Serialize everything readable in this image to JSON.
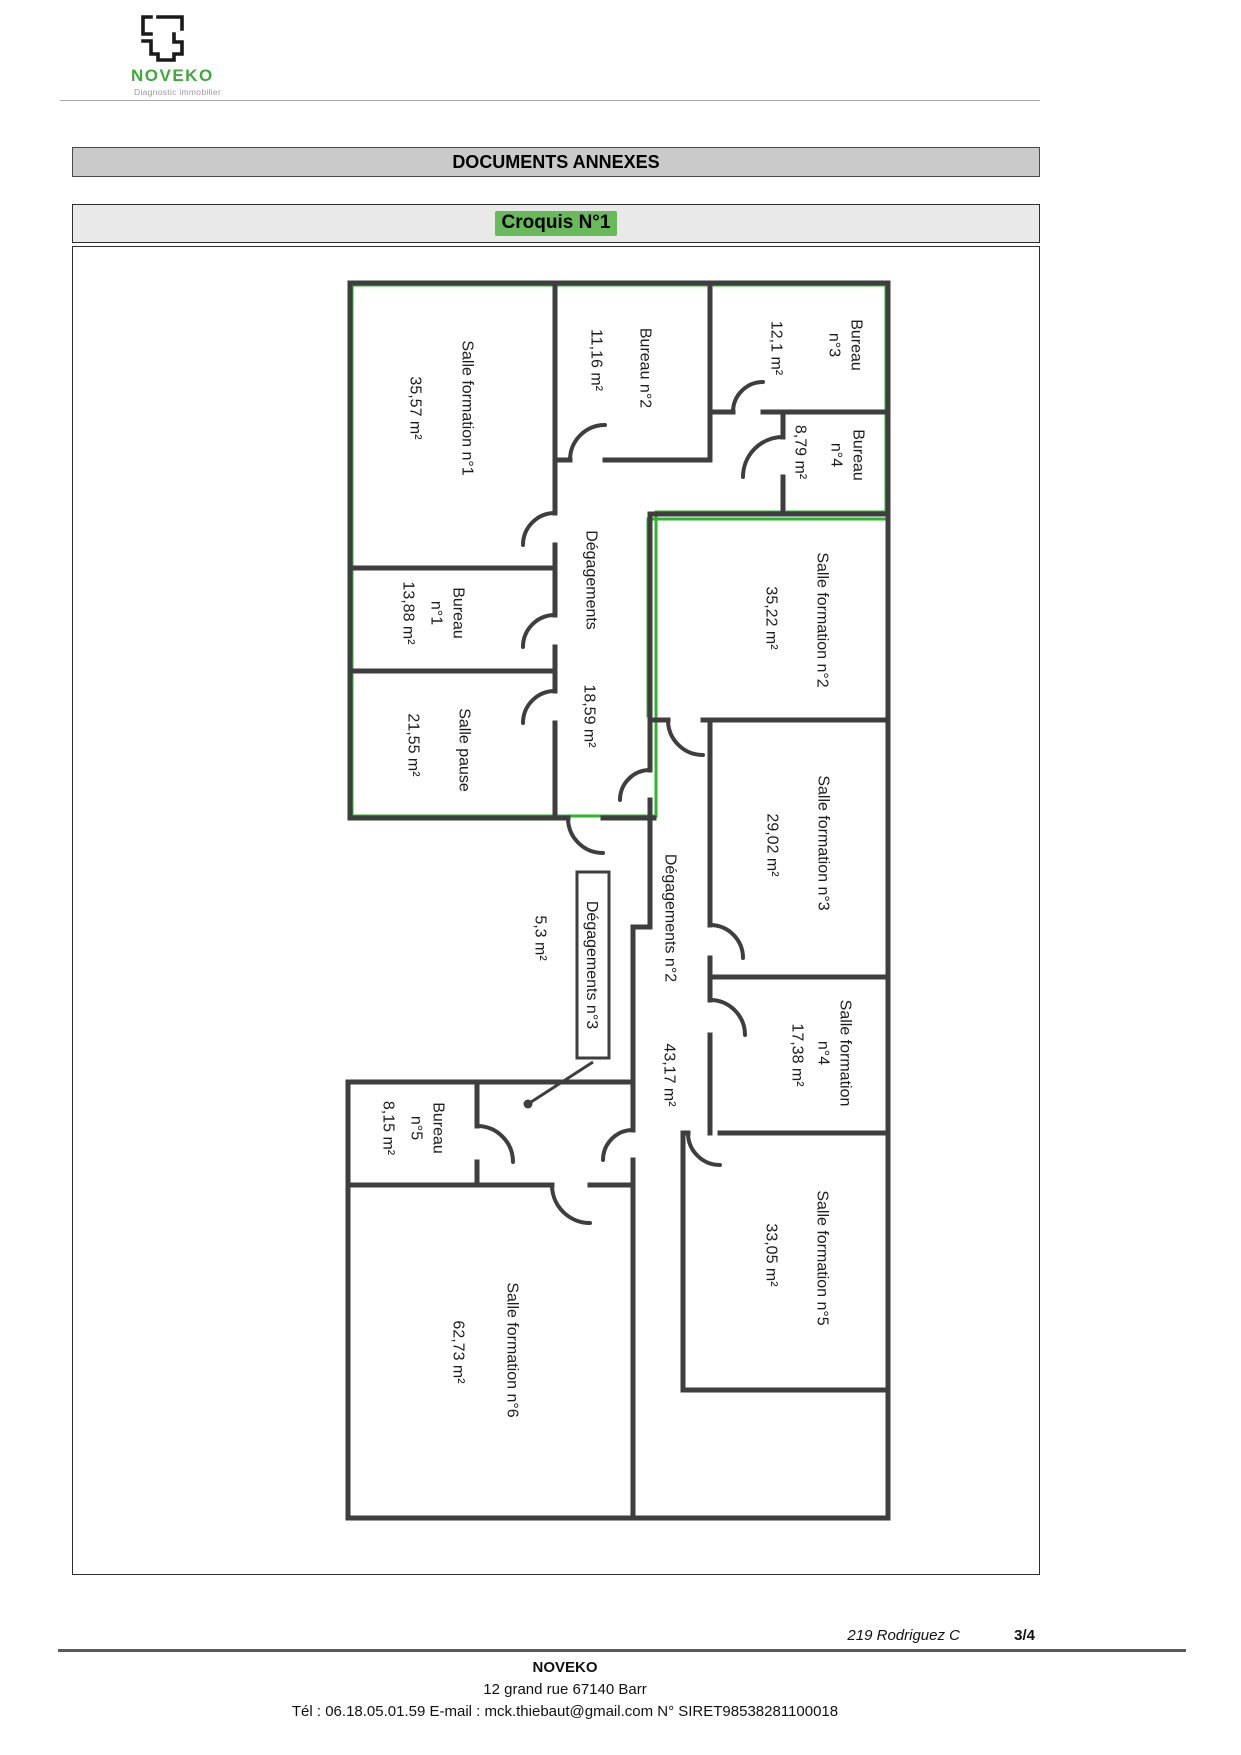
{
  "logo": {
    "brand": "NOVEKO",
    "tagline": "Diagnostic immobilier",
    "brand_color": "#3fa83f"
  },
  "header": {
    "title": "DOCUMENTS ANNEXES"
  },
  "croquis": {
    "title": "Croquis N°1",
    "highlight_color": "#68ba5a"
  },
  "floorplan": {
    "wall_color": "#3e3e3e",
    "lot_outline_color": "#2db52d",
    "rooms": [
      {
        "name": "Salle formation n°1",
        "area": "35,57 m²"
      },
      {
        "name": "Bureau n°2",
        "area": "11,16 m²"
      },
      {
        "name": "Bureau n°3",
        "line1": "Bureau",
        "line2": "n°3",
        "area": "12,1 m²"
      },
      {
        "name": "Bureau n°4",
        "line1": "Bureau",
        "line2": "n°4",
        "area": "8,79 m²"
      },
      {
        "name": "Bureau n°1",
        "line1": "Bureau",
        "line2": "n°1",
        "area": "13,88 m²"
      },
      {
        "name": "Salle pause",
        "area": "21,55 m²"
      },
      {
        "name": "Dégagements",
        "area": "18,59 m²"
      },
      {
        "name": "Salle formation n°2",
        "area": "35,22 m²"
      },
      {
        "name": "Salle formation n°3",
        "area": "29,02 m²"
      },
      {
        "name": "Dégagements n°2",
        "area": "43,17 m²"
      },
      {
        "name": "Dégagements n°3",
        "area": "5,3 m²"
      },
      {
        "name": "Salle formation n°4",
        "line1": "Salle formation",
        "line2": "n°4",
        "area": "17,38 m²"
      },
      {
        "name": "Bureau n°5",
        "line1": "Bureau",
        "line2": "n°5",
        "area": "8,15 m²"
      },
      {
        "name": "Salle formation n°5",
        "area": "33,05 m²"
      },
      {
        "name": "Salle formation n°6",
        "area": "62,73 m²"
      }
    ]
  },
  "footer": {
    "reference": "219 Rodriguez C",
    "page": "3/4",
    "company": "NOVEKO",
    "address": "12 grand rue  67140  Barr",
    "contact": "Tél : 06.18.05.01.59  E-mail : mck.thiebaut@gmail.com  N° SIRET98538281100018"
  }
}
